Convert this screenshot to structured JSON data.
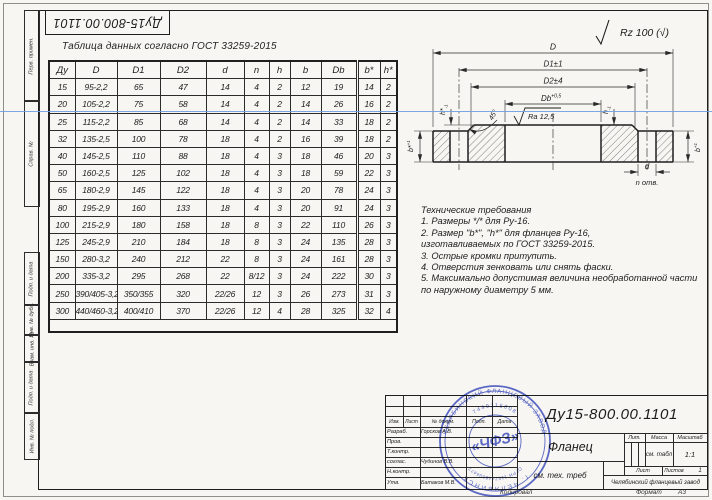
{
  "sheet": {
    "top_left_number": "Ду15-800.00.1101",
    "margin_labels": [
      "Перв. примен.",
      "Справ. №",
      "Подп. и дата",
      "Инв. № дубл.",
      "Взам. инв. №",
      "Подп. и дата",
      "Инв. № подл."
    ]
  },
  "table": {
    "caption": "Таблица данных согласно ГОСТ  33259-2015",
    "headers": [
      "Ду",
      "D",
      "D1",
      "D2",
      "d",
      "n",
      "h",
      "b",
      "Db",
      "b*",
      "h*"
    ],
    "rows": [
      [
        "15",
        "95-2,2",
        "65",
        "47",
        "14",
        "4",
        "2",
        "12",
        "19",
        "14",
        "2"
      ],
      [
        "20",
        "105-2,2",
        "75",
        "58",
        "14",
        "4",
        "2",
        "14",
        "26",
        "16",
        "2"
      ],
      [
        "25",
        "115-2,2",
        "85",
        "68",
        "14",
        "4",
        "2",
        "14",
        "33",
        "18",
        "2"
      ],
      [
        "32",
        "135-2,5",
        "100",
        "78",
        "18",
        "4",
        "2",
        "16",
        "39",
        "18",
        "2"
      ],
      [
        "40",
        "145-2,5",
        "110",
        "88",
        "18",
        "4",
        "3",
        "18",
        "46",
        "20",
        "3"
      ],
      [
        "50",
        "160-2,5",
        "125",
        "102",
        "18",
        "4",
        "3",
        "18",
        "59",
        "22",
        "3"
      ],
      [
        "65",
        "180-2,9",
        "145",
        "122",
        "18",
        "4",
        "3",
        "20",
        "78",
        "24",
        "3"
      ],
      [
        "80",
        "195-2,9",
        "160",
        "133",
        "18",
        "4",
        "3",
        "20",
        "91",
        "24",
        "3"
      ],
      [
        "100",
        "215-2,9",
        "180",
        "158",
        "18",
        "8",
        "3",
        "22",
        "110",
        "26",
        "3"
      ],
      [
        "125",
        "245-2,9",
        "210",
        "184",
        "18",
        "8",
        "3",
        "24",
        "135",
        "28",
        "3"
      ],
      [
        "150",
        "280-3,2",
        "240",
        "212",
        "22",
        "8",
        "3",
        "24",
        "161",
        "28",
        "3"
      ],
      [
        "200",
        "335-3,2",
        "295",
        "268",
        "22",
        "8/12",
        "3",
        "24",
        "222",
        "30",
        "3"
      ],
      [
        "250",
        "390/405-3,2",
        "350/355",
        "320",
        "22/26",
        "12",
        "3",
        "26",
        "273",
        "31",
        "3"
      ],
      [
        "300",
        "440/460-3,2",
        "400/410",
        "370",
        "22/26",
        "12",
        "4",
        "28",
        "325",
        "32",
        "4"
      ]
    ]
  },
  "tech": {
    "title": "Технические требования",
    "lines": [
      "1. Размеры */* для Ру-16.",
      "2. Размер \"b*\", \"h*\" для фланцев Ру-16,",
      "изготавливаемых по ГОСТ 33259-2015.",
      "3. Острые кромки притупить.",
      "4. Отверстия зенковать или снять фаски.",
      "5. Максимально допустимая величина необработанной части",
      "по наружному диаметру 5 мм."
    ]
  },
  "drawing": {
    "rz_corner": "Rz 100 (√)",
    "dims": {
      "D": "D",
      "D1": "D1±1",
      "D2": "D2±4",
      "Db": "Db",
      "Db_tol": "+0,5",
      "ra": "Ra 12,5",
      "chamfer": "45°",
      "h_star": "h*",
      "h": "h",
      "tol_m1": "-1",
      "b_star": "b*",
      "b": "b",
      "tol_p1": "+1",
      "d": "d",
      "n_holes": "n отв."
    }
  },
  "title_block": {
    "doc_number": "Ду15-800.00.1101",
    "part_name": "Фланец",
    "material_note": "см. тех. треб",
    "company": "Челябинский фланцевый завод",
    "lit_label": "Лит.",
    "mass_label": "Масса",
    "scale_label": "Масштаб",
    "mass_value": "см. табл",
    "scale_value": "1:1",
    "sheet_label": "Лист",
    "sheets_label": "Листов",
    "sheets_value": "1",
    "header_cols": [
      "Изм.",
      "Лист",
      "№ докум.",
      "Подп.",
      "Дата"
    ],
    "roles": [
      {
        "label": "Разраб.",
        "name": "Горсков А.В."
      },
      {
        "label": "Пров.",
        "name": ""
      },
      {
        "label": "Т.контр.",
        "name": ""
      },
      {
        "label": "соглас.",
        "name": "Чудинов В.В."
      },
      {
        "label": "Н.контр.",
        "name": ""
      },
      {
        "label": "Утв.",
        "name": "Батаков М.В."
      }
    ],
    "footer": {
      "copied": "Копировал",
      "format_label": "Формат",
      "format_value": "А3"
    }
  },
  "stamp": {
    "outer_top": "ЧЕЛЯБИНСКИЙ ФЛАНЦЕВЫЙ ЗАВОД",
    "outer_bottom": "г. ЧЕЛЯБИНСК",
    "inner_top": "7449115808",
    "inner_bottom": "ОГРН 1157448004477",
    "center": "«ЧФЗ»",
    "color": "#3a4cc4"
  }
}
